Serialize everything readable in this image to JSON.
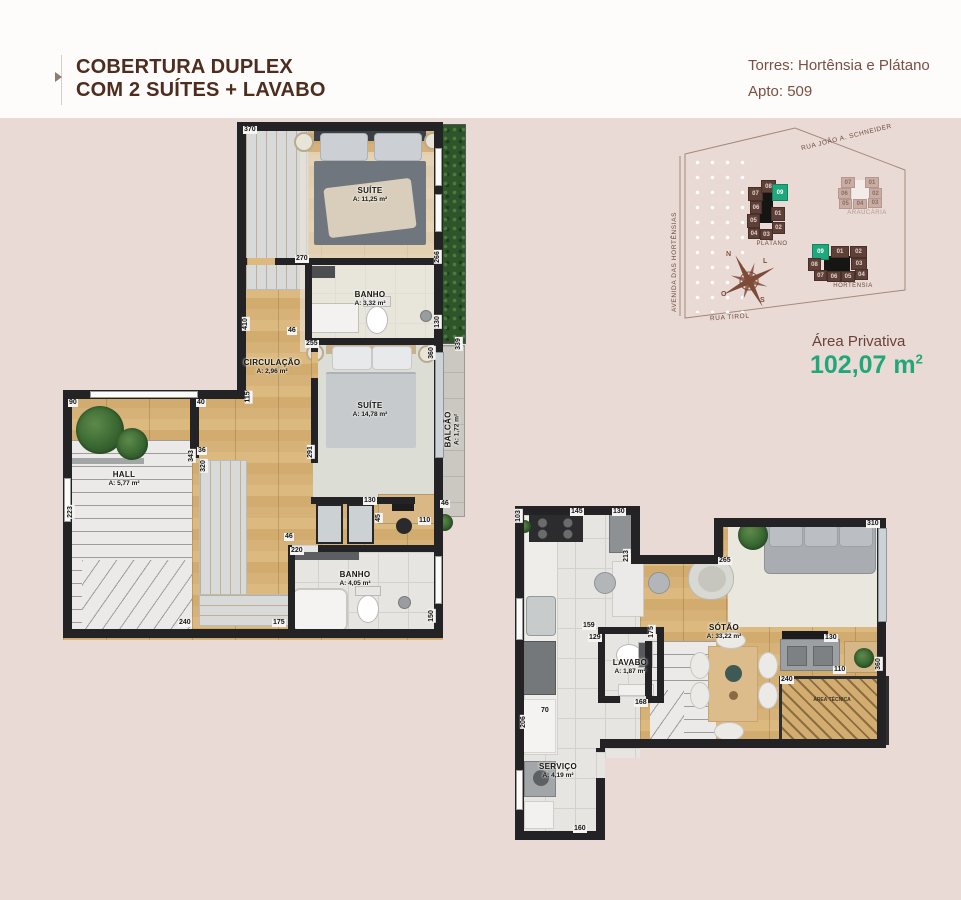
{
  "header": {
    "title_line1": "COBERTURA DUPLEX",
    "title_line2": "COM 2 SUÍTES + LAVABO",
    "tower_info": "Torres: Hortênsia e Plátano",
    "apto_info": "Apto: 509"
  },
  "area": {
    "label": "Área Privativa",
    "value": "102,07 m",
    "sup": "2"
  },
  "map": {
    "streets": {
      "top": "RUA JOÃO A. SCHNEIDER",
      "left": "AVENIDA DAS HORTÊNSIAS",
      "bottom": "RUA TIROL"
    },
    "compass": {
      "n": "N",
      "l": "L",
      "o": "O",
      "s": "S"
    },
    "towers": {
      "platano": {
        "label": "PLÁTANO",
        "highlight": "09",
        "units": [
          "07",
          "08",
          "09",
          "06",
          "01",
          "05",
          "04",
          "03",
          "02"
        ]
      },
      "araucaria": {
        "label": "ARAUCÁRIA",
        "units": [
          "07",
          "01",
          "06",
          "02",
          "05",
          "04",
          "03"
        ]
      },
      "hortensia": {
        "label": "HORTÊNSIA",
        "highlight": "09",
        "units": [
          "09",
          "01",
          "02",
          "08",
          "03",
          "07",
          "06",
          "05",
          "04"
        ]
      }
    }
  },
  "plans": {
    "upper": {
      "rooms": [
        {
          "name": "SUÍTE",
          "area": "A: 11,25 m²"
        },
        {
          "name": "BANHO",
          "area": "A: 3,32 m²"
        },
        {
          "name": "CIRCULAÇÃO",
          "area": "A: 2,96 m²"
        },
        {
          "name": "SUÍTE",
          "area": "A: 14,78 m²"
        },
        {
          "name": "BALCÃO",
          "area": "A: 1,72 m²"
        },
        {
          "name": "HALL",
          "area": "A: 5,77 m²"
        },
        {
          "name": "BANHO",
          "area": "A: 4,05 m²"
        }
      ],
      "dims": [
        "370",
        "270",
        "266",
        "255",
        "360",
        "339",
        "130",
        "410",
        "46",
        "291",
        "36",
        "343",
        "320",
        "223",
        "90",
        "40",
        "115",
        "240",
        "175",
        "130",
        "46",
        "45",
        "110",
        "220",
        "150",
        "46"
      ]
    },
    "lower": {
      "rooms": [
        {
          "name": "LAVABO",
          "area": "A: 1,87 m²"
        },
        {
          "name": "SÓTÃO",
          "area": "A: 33,22 m²"
        },
        {
          "name": "SERVIÇO",
          "area": "A: 4,19 m²"
        }
      ],
      "hatch_label": "ÁREA TÉCNICA",
      "dims": [
        "103",
        "145",
        "130",
        "213",
        "265",
        "310",
        "159",
        "129",
        "175",
        "130",
        "110",
        "360",
        "240",
        "70",
        "168",
        "206",
        "160"
      ]
    }
  },
  "colors": {
    "accent_green": "#1ea87c",
    "brand_brown": "#4e2c1e",
    "wall": "#232326",
    "background": "#e9dad6"
  }
}
